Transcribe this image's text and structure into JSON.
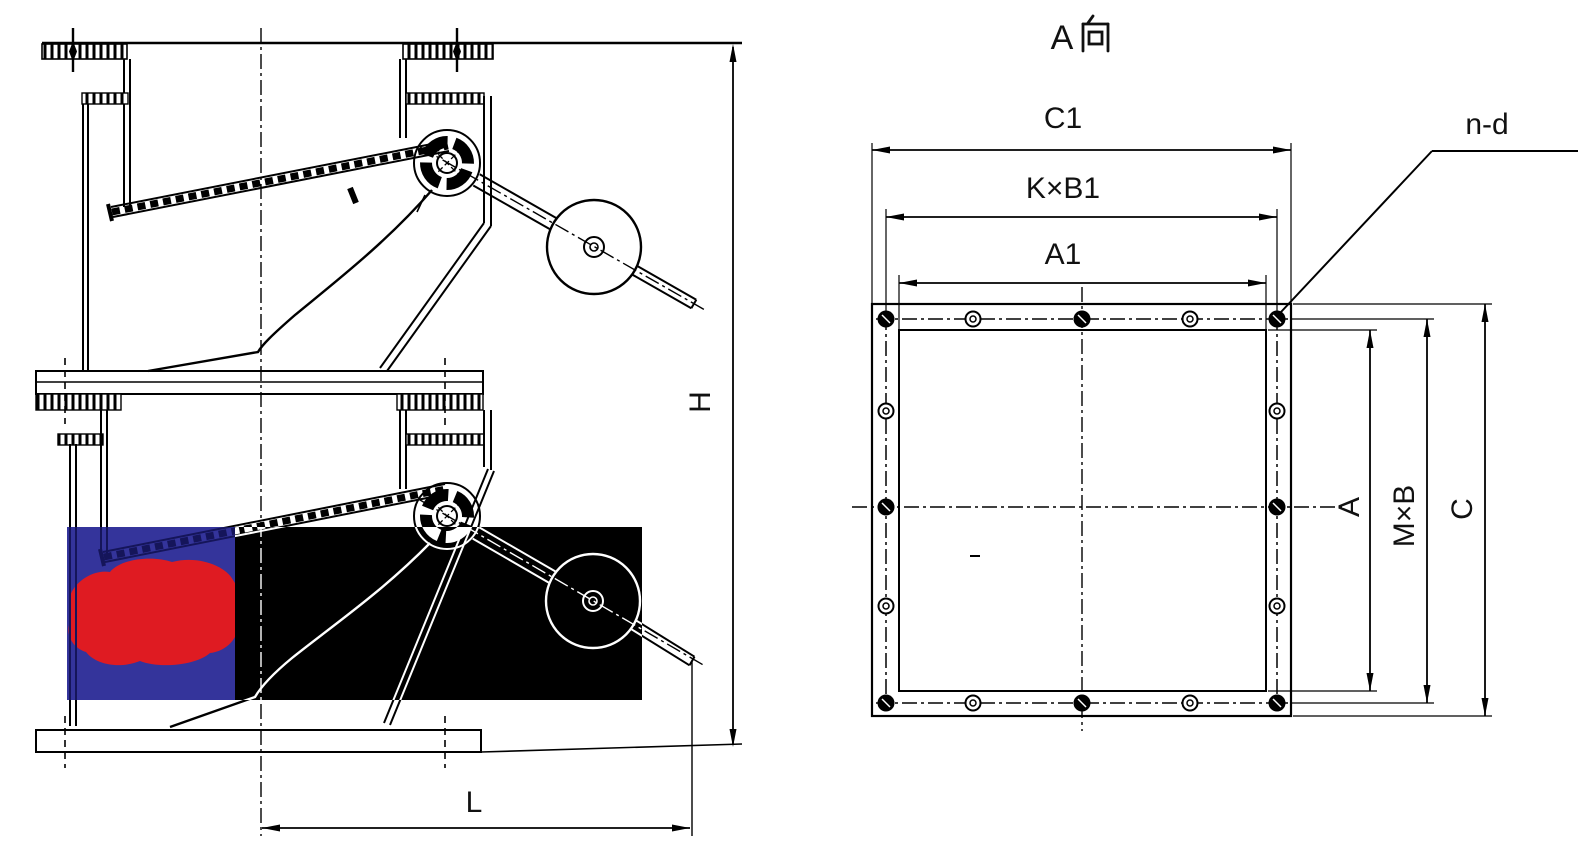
{
  "page": {
    "background": "#ffffff"
  },
  "drawing": {
    "kind": "two-stage damper technical drawing",
    "left_view": {
      "dim_labels": {
        "h": "H",
        "l": "L"
      }
    },
    "flange_view": {
      "title_full": "A向",
      "title_latin": "A",
      "title_cjk": "向",
      "dim_labels": {
        "c1": "C1",
        "kxb1": "K×B1",
        "a1": "A1",
        "nd": "n-d",
        "a": "A",
        "mxb": "M×B",
        "c": "C"
      },
      "bolt_holes": {
        "per_side": 5,
        "total": 16
      }
    },
    "overlay": {
      "blue": "#34349B",
      "red": "#DF1B22",
      "black": "#000000",
      "line_over_blue": "#15155A",
      "line_over_black": "#FFFFFF"
    }
  }
}
